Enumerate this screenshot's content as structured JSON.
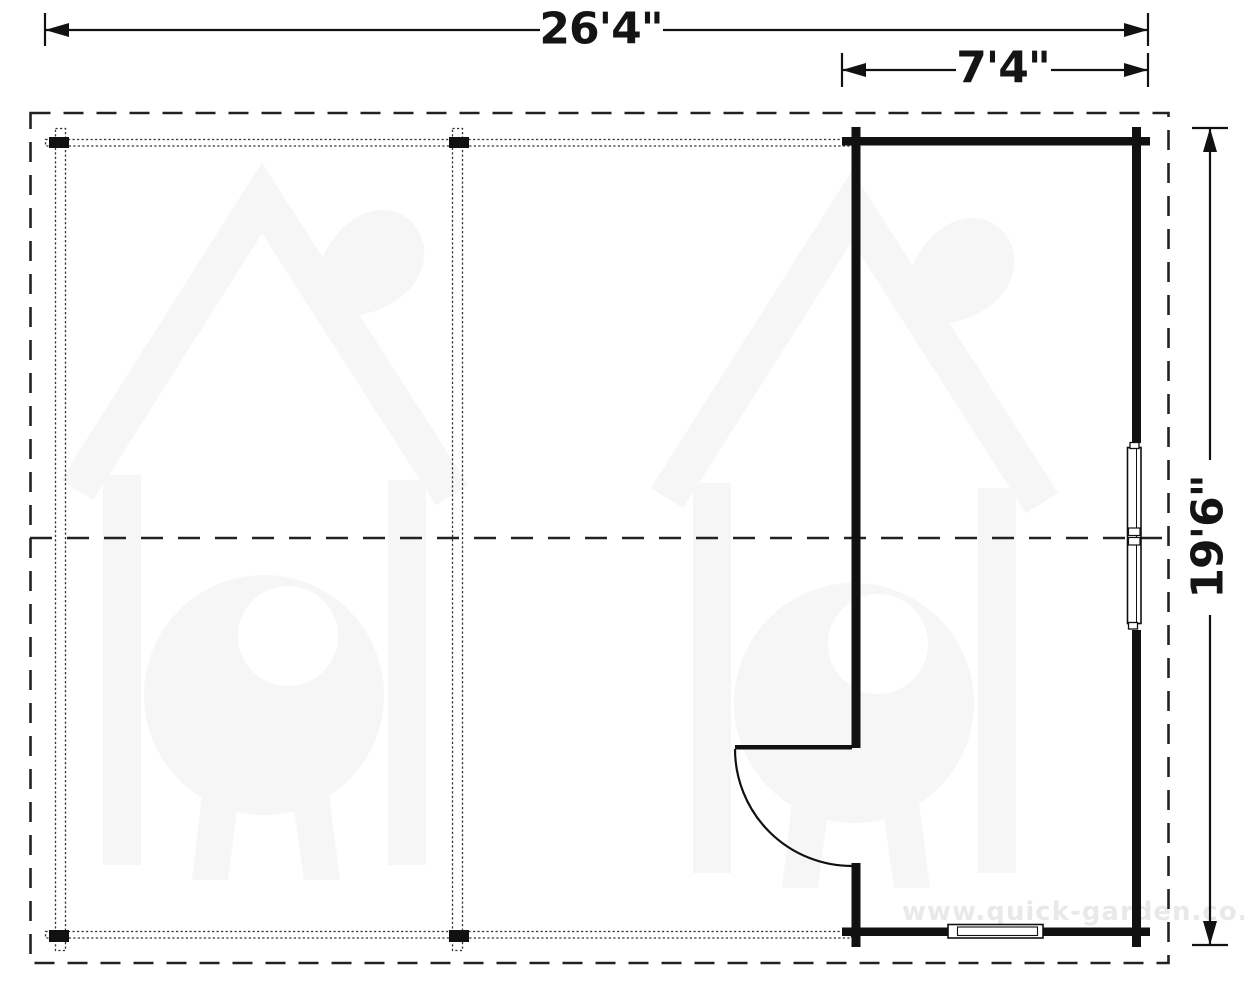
{
  "plan": {
    "title": "log-cabin-carport-floor-plan",
    "dimensions": {
      "overall_width": "26'4\"",
      "annex_width": "7'4\"",
      "depth": "19'6\""
    },
    "watermark": {
      "url_text": "www.quick-garden.co.uk",
      "logo_icon": "house-with-tree-logo"
    },
    "features": {
      "posts_count": 4,
      "door": "single swing door, left wall of annex, opens outward",
      "windows": [
        "right wall window",
        "bottom wall window"
      ]
    },
    "colors": {
      "line_black": "#141414",
      "dash_gray": "#2a2a2a",
      "watermark_logo": "#f6f6f6",
      "watermark_text": "#e9e9e9",
      "background": "#ffffff"
    }
  }
}
